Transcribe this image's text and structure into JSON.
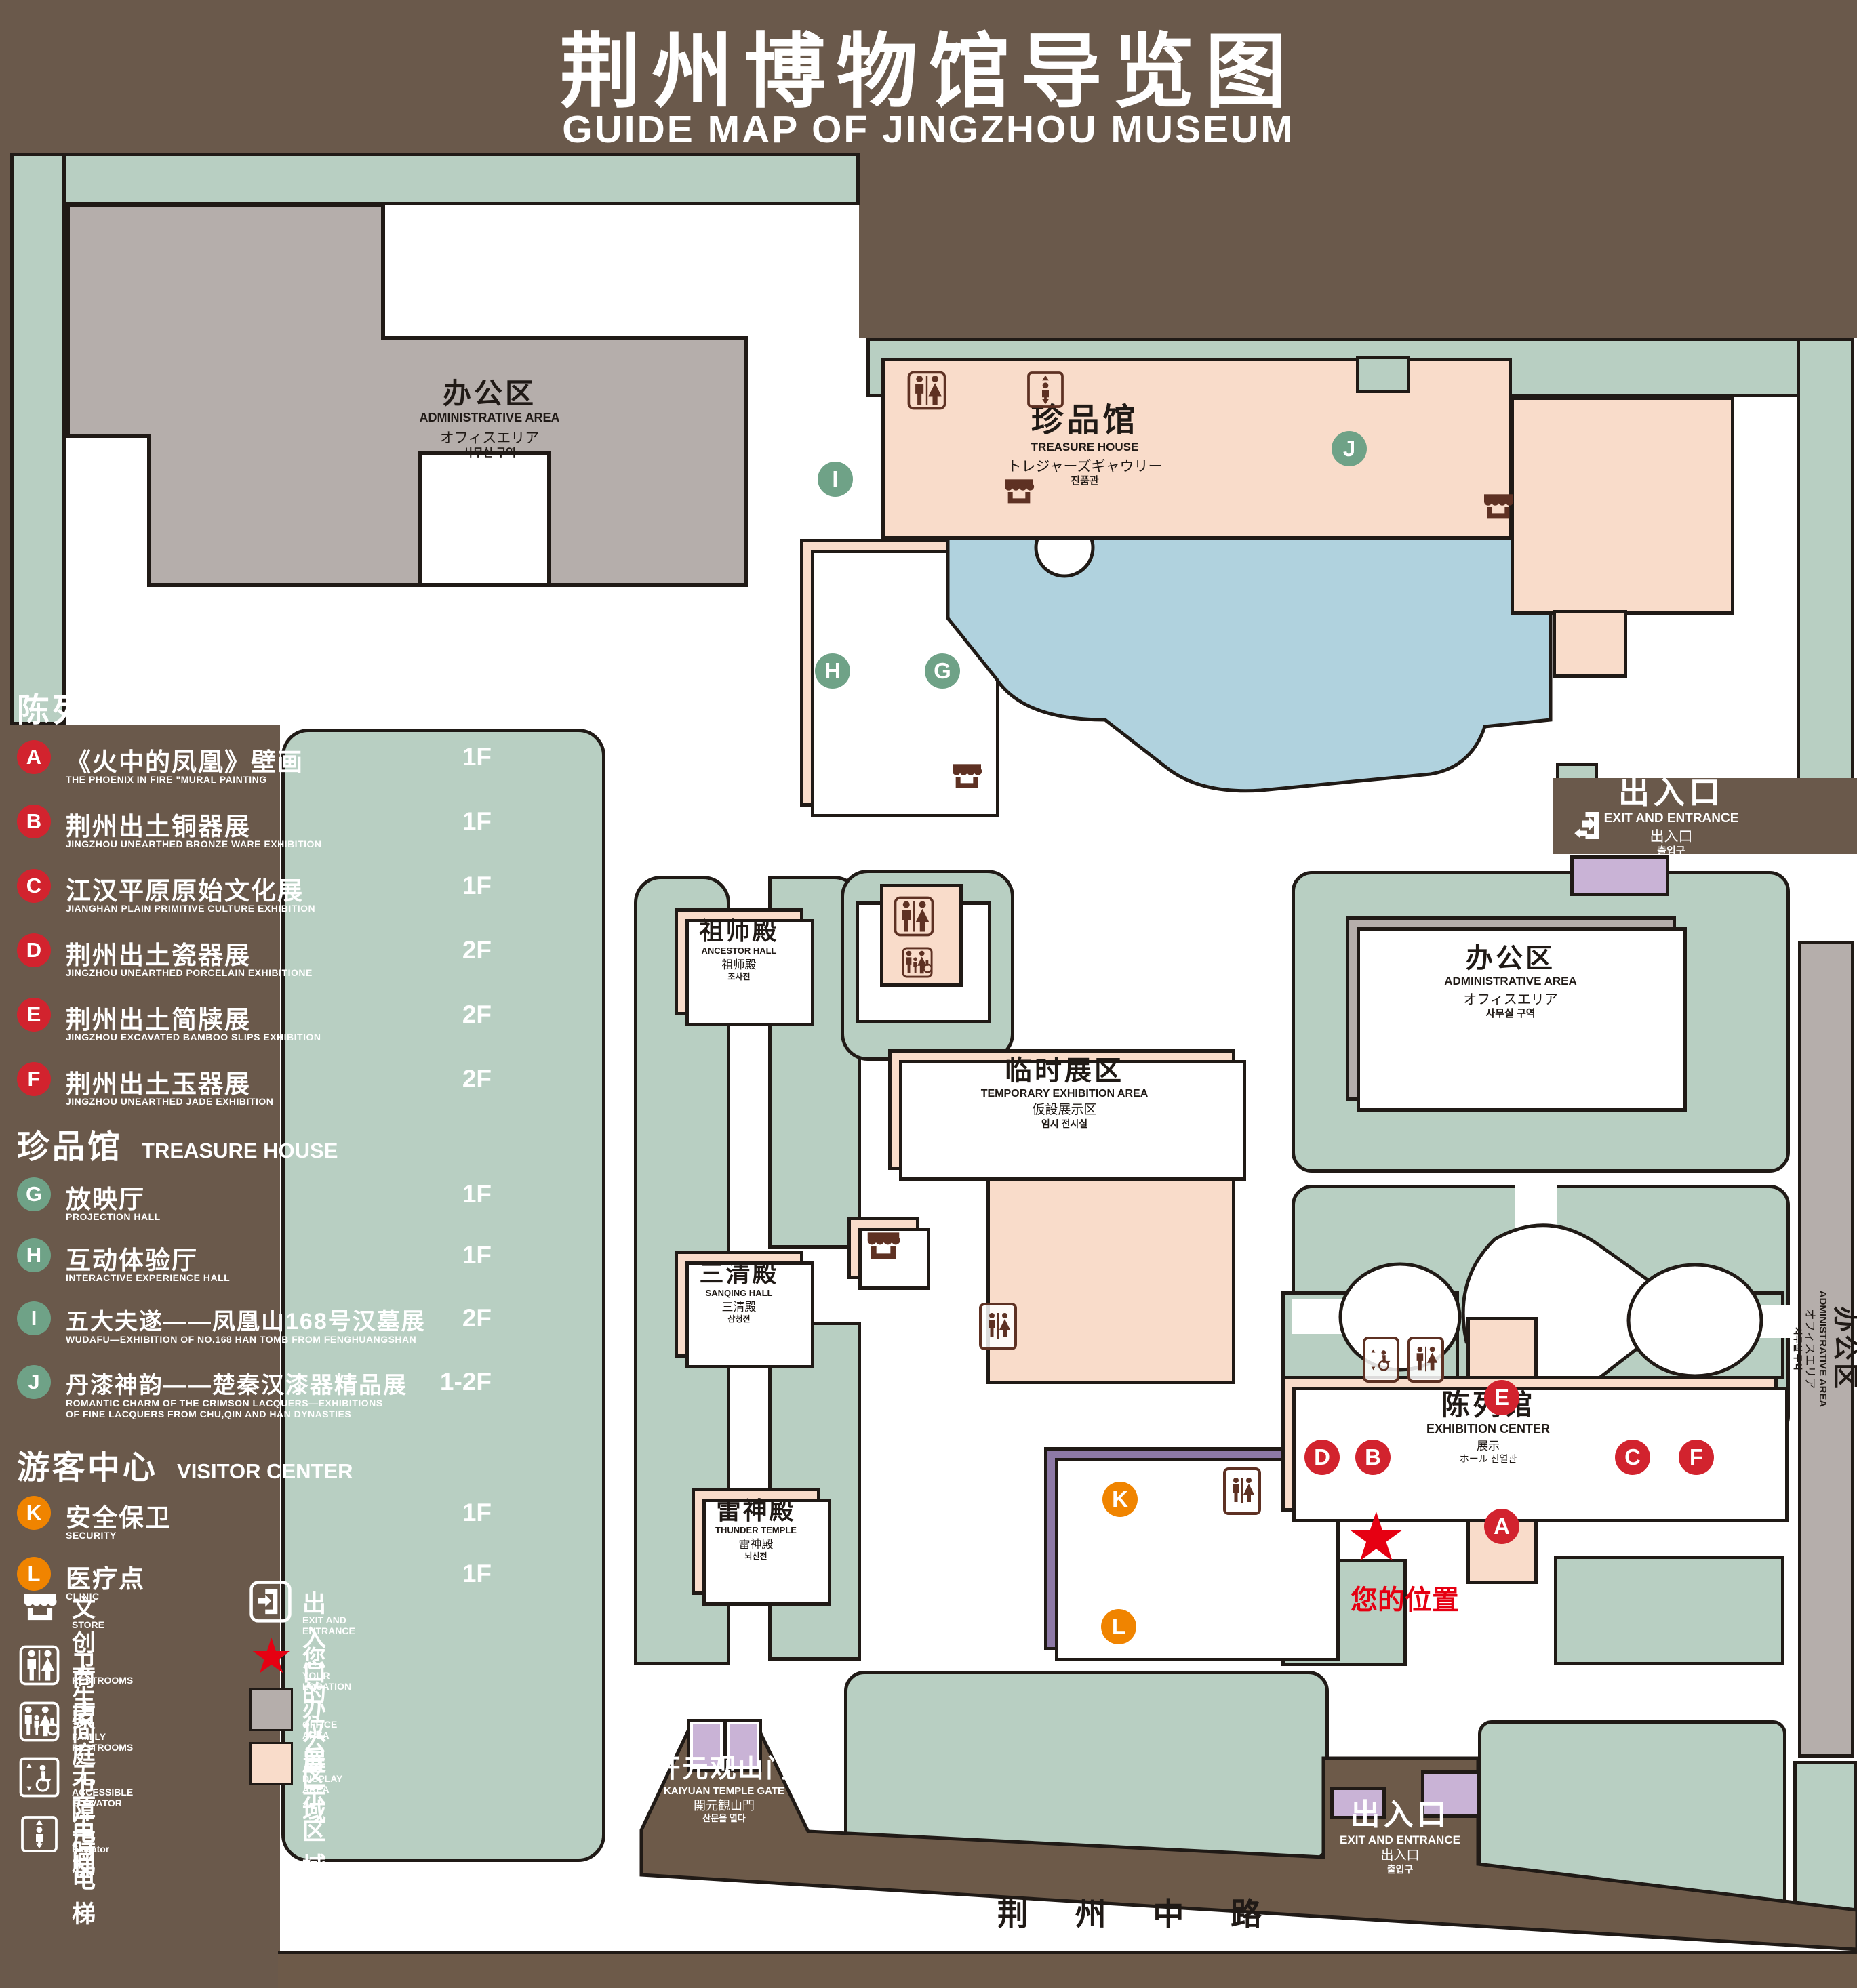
{
  "title": {
    "zh": "荆州博物馆导览图",
    "en": "GUIDE MAP OF JINGZHOU MUSEUM"
  },
  "colors": {
    "background": "#6a594b",
    "lawn_green": "#b8cfc2",
    "display_pink": "#f9dcca",
    "office_gray": "#b5aeab",
    "visitor_purple": "#8d79a6",
    "gate_purple": "#c9b3d6",
    "pond_blue": "#b0d2de",
    "road_brown": "#6d5a49",
    "marker_red": "#d2232e",
    "marker_green": "#6fa287",
    "marker_orange": "#f08400",
    "star_red": "#e60012",
    "outline": "#201a16"
  },
  "legend": {
    "sections": [
      {
        "title_zh": "陈列馆",
        "title_en": "EXHIBITION CENTER",
        "items": [
          {
            "id": "A",
            "zh": "《火中的凤凰》壁画",
            "en": "THE PHOENIX IN FIRE \"MURAL PAINTING",
            "floor": "1F"
          },
          {
            "id": "B",
            "zh": "荆州出土铜器展",
            "en": "JINGZHOU UNEARTHED BRONZE WARE EXHIBITION",
            "floor": "1F"
          },
          {
            "id": "C",
            "zh": "江汉平原原始文化展",
            "en": "JIANGHAN PLAIN PRIMITIVE CULTURE EXHIBITION",
            "floor": "1F"
          },
          {
            "id": "D",
            "zh": "荆州出土瓷器展",
            "en": "JINGZHOU UNEARTHED PORCELAIN EXHIBITIONE",
            "floor": "2F"
          },
          {
            "id": "E",
            "zh": "荆州出土简牍展",
            "en": "JINGZHOU EXCAVATED BAMBOO SLIPS EXHIBITION",
            "floor": "2F"
          },
          {
            "id": "F",
            "zh": "荆州出土玉器展",
            "en": "JINGZHOU UNEARTHED JADE EXHIBITION",
            "floor": "2F"
          }
        ]
      },
      {
        "title_zh": "珍品馆",
        "title_en": "TREASURE HOUSE",
        "items": [
          {
            "id": "G",
            "zh": "放映厅",
            "en": "PROJECTION HALL",
            "floor": "1F"
          },
          {
            "id": "H",
            "zh": "互动体验厅",
            "en": "INTERACTIVE EXPERIENCE HALL",
            "floor": "1F"
          },
          {
            "id": "I",
            "zh": "五大夫遂——凤凰山168号汉墓展",
            "en": "WUDAFU—EXHIBITION OF NO.168 HAN TOMB FROM FENGHUANGSHAN",
            "floor": "2F"
          },
          {
            "id": "J",
            "zh": "丹漆神韵——楚秦汉漆器精品展",
            "en": "ROMANTIC CHARM OF THE CRIMSON LACQUERS—EXHIBITIONS\nOF FINE LACQUERS FROM CHU,QIN AND HAN DYNASTIES",
            "floor": "1-2F"
          }
        ]
      },
      {
        "title_zh": "游客中心",
        "title_en": "VISITOR CENTER",
        "items": [
          {
            "id": "K",
            "zh": "安全保卫",
            "en": "SECURITY",
            "floor": "1F"
          },
          {
            "id": "L",
            "zh": "医疗点",
            "en": "CLINIC",
            "floor": "1F"
          }
        ]
      }
    ],
    "facilities": [
      {
        "zh": "文创商店",
        "en": "STORE"
      },
      {
        "zh": "卫生间",
        "en": "RESTROOMS"
      },
      {
        "zh": "家庭卫生间",
        "en": "FAMILY RESTROOMS"
      },
      {
        "zh": "无障碍电梯",
        "en": "ACCESSIBLE ELEVATOR"
      },
      {
        "zh": "电梯",
        "en": "Elevator"
      }
    ],
    "right_column": [
      {
        "zh": "出入口",
        "en": "EXIT AND ENTRANCE"
      },
      {
        "zh": "您的位置",
        "en": "YOUR LOCATION"
      },
      {
        "zh": "办公区域",
        "en": "OFFICE AREA"
      },
      {
        "zh": "展示区域",
        "en": "DISPLAY AREA"
      }
    ]
  },
  "map": {
    "admin_area": {
      "zh": "办公区",
      "en": "ADMINISTRATIVE AREA",
      "ja": "オフィスエリア",
      "ko": "사무실 구역"
    },
    "treasure_house": {
      "zh": "珍品馆",
      "en": "TREASURE HOUSE",
      "ja": "トレジャーズギャウリー",
      "ko": "진품관"
    },
    "ancestor_hall": {
      "zh": "祖师殿",
      "en": "ANCESTOR HALL",
      "ja": "祖师殿",
      "ko": "조사전"
    },
    "sanqing_hall": {
      "zh": "三清殿",
      "en": "SANQING HALL",
      "ja": "三清殿",
      "ko": "삼청전"
    },
    "thunder_temple": {
      "zh": "雷神殿",
      "en": "THUNDER TEMPLE",
      "ja": "雷神殿",
      "ko": "뇌신전"
    },
    "temporary_area": {
      "zh": "临时展区",
      "en": "TEMPORARY EXHIBITION AREA",
      "ja": "仮設展示区",
      "ko": "임시 전시실"
    },
    "visitor_center": {
      "zh": "游客中心",
      "en": "VISITOR CENTER",
      "ja": "ビジターセンター",
      "ko": "관광객 센터"
    },
    "exhibition_center": {
      "zh": "陈列馆",
      "en": "EXHIBITION CENTER",
      "l3": "展示",
      "l4": "ホール 진열관"
    },
    "gate": {
      "zh": "开元观山门",
      "en": "KAIYUAN TEMPLE GATE",
      "ja": "開元観山門",
      "ko": "산문을 열다"
    },
    "exit": {
      "zh": "出入口",
      "en": "EXIT AND ENTRANCE",
      "ja": "出入口",
      "ko": "출입구"
    },
    "your_location": "您的位置",
    "road": "荆 州 中 路",
    "markers": {
      "A": "A",
      "B": "B",
      "C": "C",
      "D": "D",
      "E": "E",
      "F": "F",
      "G": "G",
      "H": "H",
      "I": "I",
      "J": "J",
      "K": "K",
      "L": "L"
    }
  }
}
